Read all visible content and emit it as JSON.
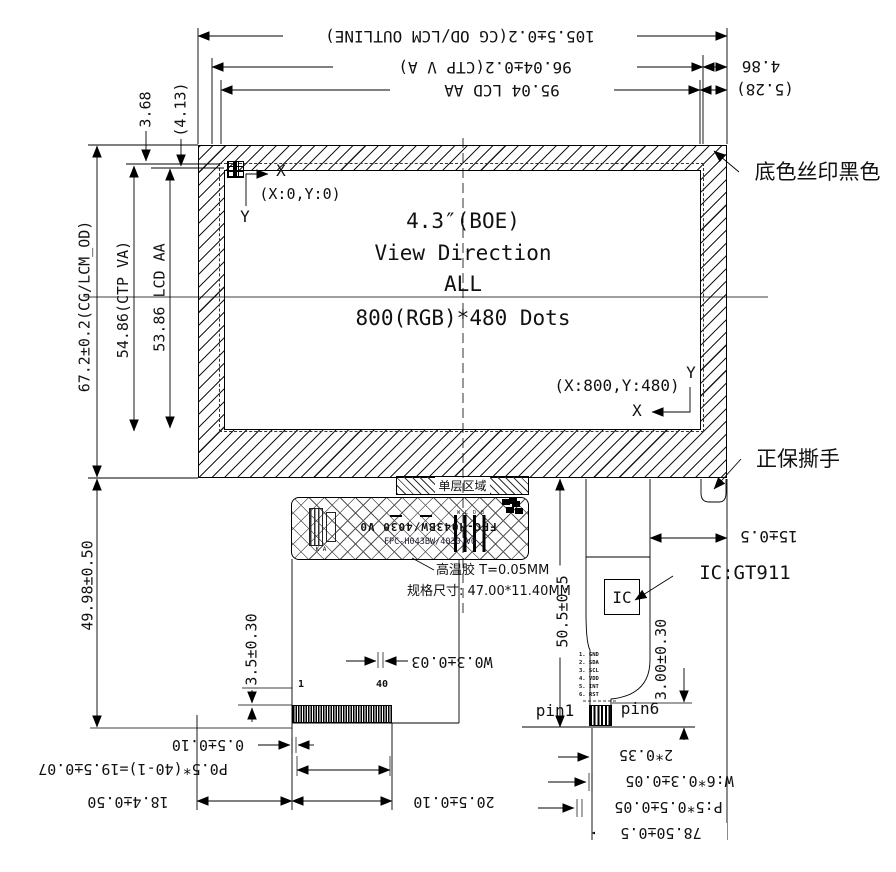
{
  "ink": "#000000",
  "display": {
    "size": "4.3″(BOE)",
    "view_direction": "View Direction",
    "direction": "ALL",
    "resolution": "800(RGB)*480 Dots",
    "origin_label": "(X:0,Y:0)",
    "endpoint_label": "(X:800,Y:480)",
    "axis_x": "X",
    "axis_y": "Y"
  },
  "dims": {
    "top": {
      "outline": "105.5±0.2(CG OD/LCM OUTLINE)",
      "ctp_va": "96.04±0.2(CTP V A)",
      "lcd_aa": "95.04 LCD AA",
      "cg_right": "4.86",
      "aa_right": "(5.28)"
    },
    "left": {
      "cg_top": "3.68",
      "aa_top": "(4.13)",
      "outline": "67.2±0.2(CG/LCM_OD)",
      "ctp_va": "54.86(CTP VA)",
      "lcd_aa": "53.86 LCD AA",
      "fpc_drop": "49.98±0.50"
    },
    "right": {
      "tear_offset": "15±0.5",
      "ctp_fpc_len": "50.5±0.5",
      "finger_len": "3.00±0.30",
      "edge_margin": "2*0.35",
      "finger_width": "W:6*0.3±0.05",
      "finger_pitch": "P:5*0.5±0.05",
      "tail_offset": "78.50±0.5"
    },
    "bottom": {
      "stiffener": "3.5±0.30",
      "finger_width": "W0.3±0.03",
      "margin": "0.5±0.10",
      "pitch": "P0.5*(40-1)=19.5±0.07",
      "conn_offset": "18.4±0.50",
      "conn_width": "20.5±0.10"
    }
  },
  "labels": {
    "silk": "底色丝印黑色",
    "tear": "正保撕手",
    "ic": "IC:GT911",
    "ic_box": "IC",
    "single_layer": "单层区域",
    "tape": "高温胶 T=0.05MM",
    "spec": "规格尺寸: 47.00*11.40MM",
    "part_no": "FPC-H043BW/4030 V0",
    "footprint": "W L D B",
    "comp_marks": "K  A"
  },
  "lcd_connector": {
    "pin_first": "1",
    "pin_last": "40"
  },
  "ctp_connector": {
    "pin1": "pin1",
    "pin6": "pin6",
    "pins": [
      "1. GND",
      "2. SDA",
      "3. SCL",
      "4. VDD",
      "5. INT",
      "6. RST"
    ]
  }
}
